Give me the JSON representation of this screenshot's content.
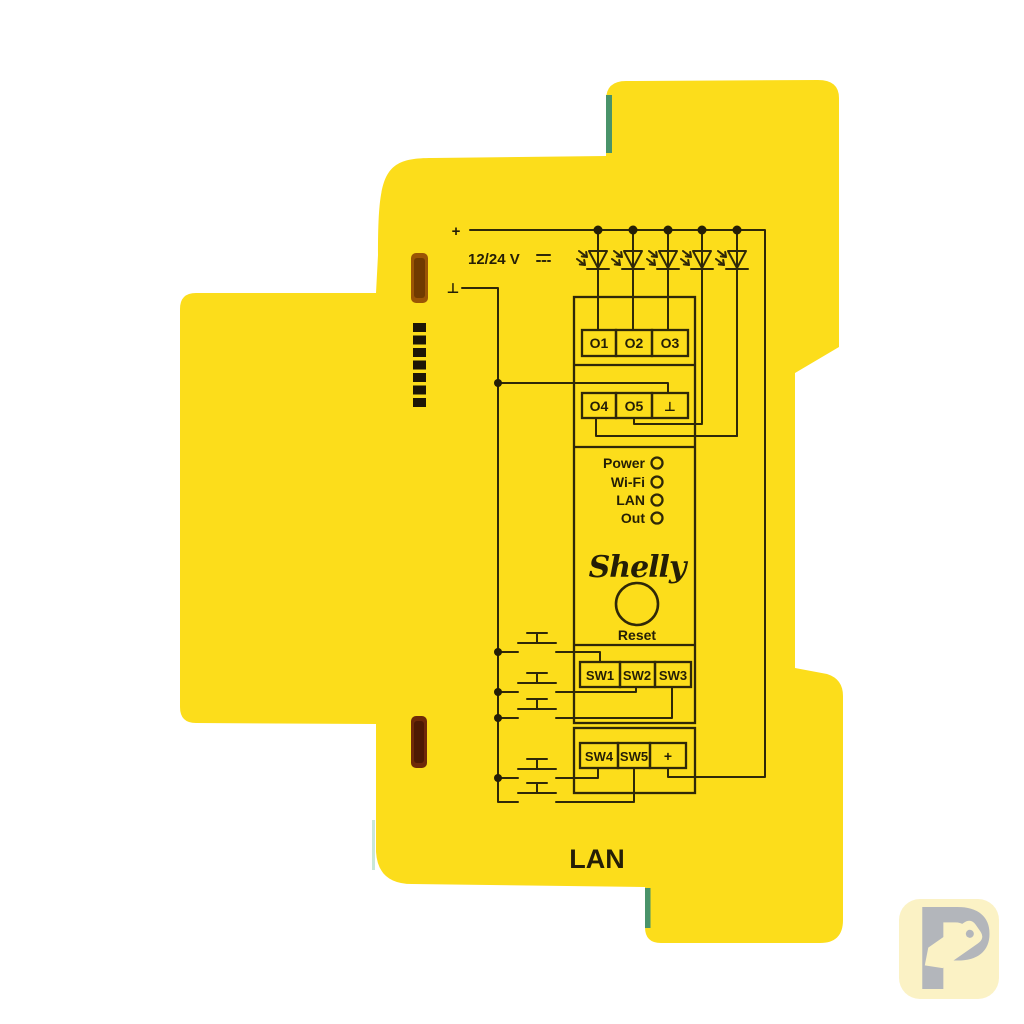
{
  "window": {
    "background_color": "#ffffff"
  },
  "device": {
    "product": "yellow-din-rail-module-side-view",
    "body_color": "#fcdd1b",
    "print_color": "#2f2808",
    "edge_accent_color": "#49936a",
    "vent_slot_top_color": "#9a5505",
    "vent_slot_bottom_color": "#6e2a08",
    "vent_hole_count": 7,
    "bottom_label": "LAN"
  },
  "diagram": {
    "power_rail": {
      "plus": "+",
      "voltage": "12/24 V",
      "dc_symbol": "⎓",
      "ground": "⊥"
    },
    "led_count": 5,
    "switch_count": 5,
    "terminals": {
      "outputs_row1": [
        "O1",
        "O2",
        "O3"
      ],
      "outputs_row2": [
        "O4",
        "O5",
        "⊥"
      ],
      "switches_row1": [
        "SW1",
        "SW2",
        "SW3"
      ],
      "switches_row2": [
        "SW4",
        "SW5",
        "+"
      ]
    },
    "status_leds": [
      "Power",
      "Wi-Fi",
      "LAN",
      "Out"
    ],
    "brand": "Shelly",
    "reset_label": "Reset"
  },
  "watermark": {
    "letter": "P",
    "background_color": "#fbf2c5",
    "glyph_color": "#b3b6bb"
  }
}
